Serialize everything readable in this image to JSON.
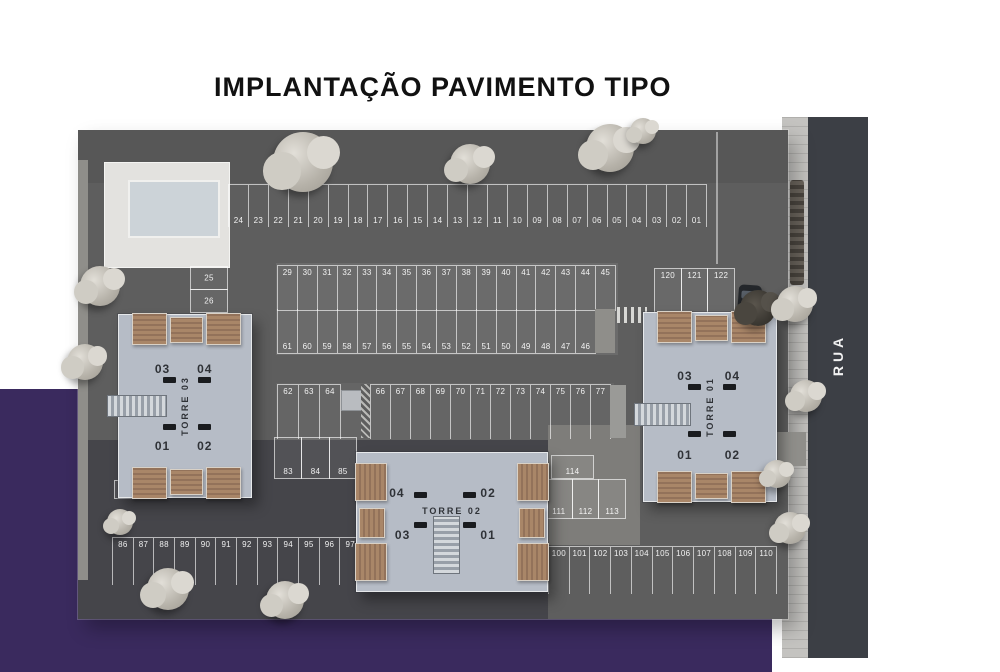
{
  "title": "IMPLANTAÇÃO PAVIMENTO TIPO",
  "street": {
    "label": "RUA"
  },
  "towers": [
    {
      "id": "torre-03",
      "name": "TORRE 03",
      "units": {
        "tl": "03",
        "tr": "04",
        "bl": "01",
        "br": "02"
      }
    },
    {
      "id": "torre-02",
      "name": "TORRE 02",
      "units": {
        "tl": "04",
        "tr": "02",
        "bl": "03",
        "br": "01"
      }
    },
    {
      "id": "torre-01",
      "name": "TORRE 01",
      "units": {
        "tl": "03",
        "tr": "04",
        "bl": "01",
        "br": "02"
      }
    }
  ],
  "parking": {
    "row_top": [
      "24",
      "23",
      "22",
      "21",
      "20",
      "19",
      "18",
      "17",
      "16",
      "15",
      "14",
      "13",
      "12",
      "11",
      "10",
      "09",
      "08",
      "07",
      "06",
      "05",
      "04",
      "03",
      "02",
      "01"
    ],
    "left_pair": [
      "25",
      "26"
    ],
    "island_upper": [
      "29",
      "30",
      "31",
      "32",
      "33",
      "34",
      "35",
      "36",
      "37",
      "38",
      "39",
      "40",
      "41",
      "42",
      "43",
      "44",
      "45"
    ],
    "island_lower": [
      "61",
      "60",
      "59",
      "58",
      "57",
      "56",
      "55",
      "54",
      "53",
      "52",
      "51",
      "50",
      "49",
      "48",
      "47",
      "46"
    ],
    "mid_row_left": [
      "62",
      "63",
      "64"
    ],
    "mid_row_right": [
      "66",
      "67",
      "68",
      "69",
      "70",
      "71",
      "72",
      "73",
      "74",
      "75",
      "76",
      "77"
    ],
    "spot_78": [
      "78"
    ],
    "spots_83_85": [
      "83",
      "84",
      "85"
    ],
    "row_bottom_left": [
      "86",
      "87",
      "88",
      "89",
      "90",
      "91",
      "92",
      "93",
      "94",
      "95",
      "96",
      "97"
    ],
    "row_bottom_right": [
      "100",
      "101",
      "102",
      "103",
      "104",
      "105",
      "106",
      "107",
      "108",
      "109",
      "110"
    ],
    "spot_114": [
      "114"
    ],
    "block_111_113": [
      "111",
      "112",
      "113"
    ],
    "block_120_122": [
      "120",
      "121",
      "122"
    ]
  },
  "colors": {
    "background_purple": "#3a2a5e",
    "asphalt": "#5e5e5e",
    "road": "#3c3f45",
    "tower_body": "#b6bcc6",
    "balcony_roof": "#a08063",
    "title_text": "#111111"
  }
}
